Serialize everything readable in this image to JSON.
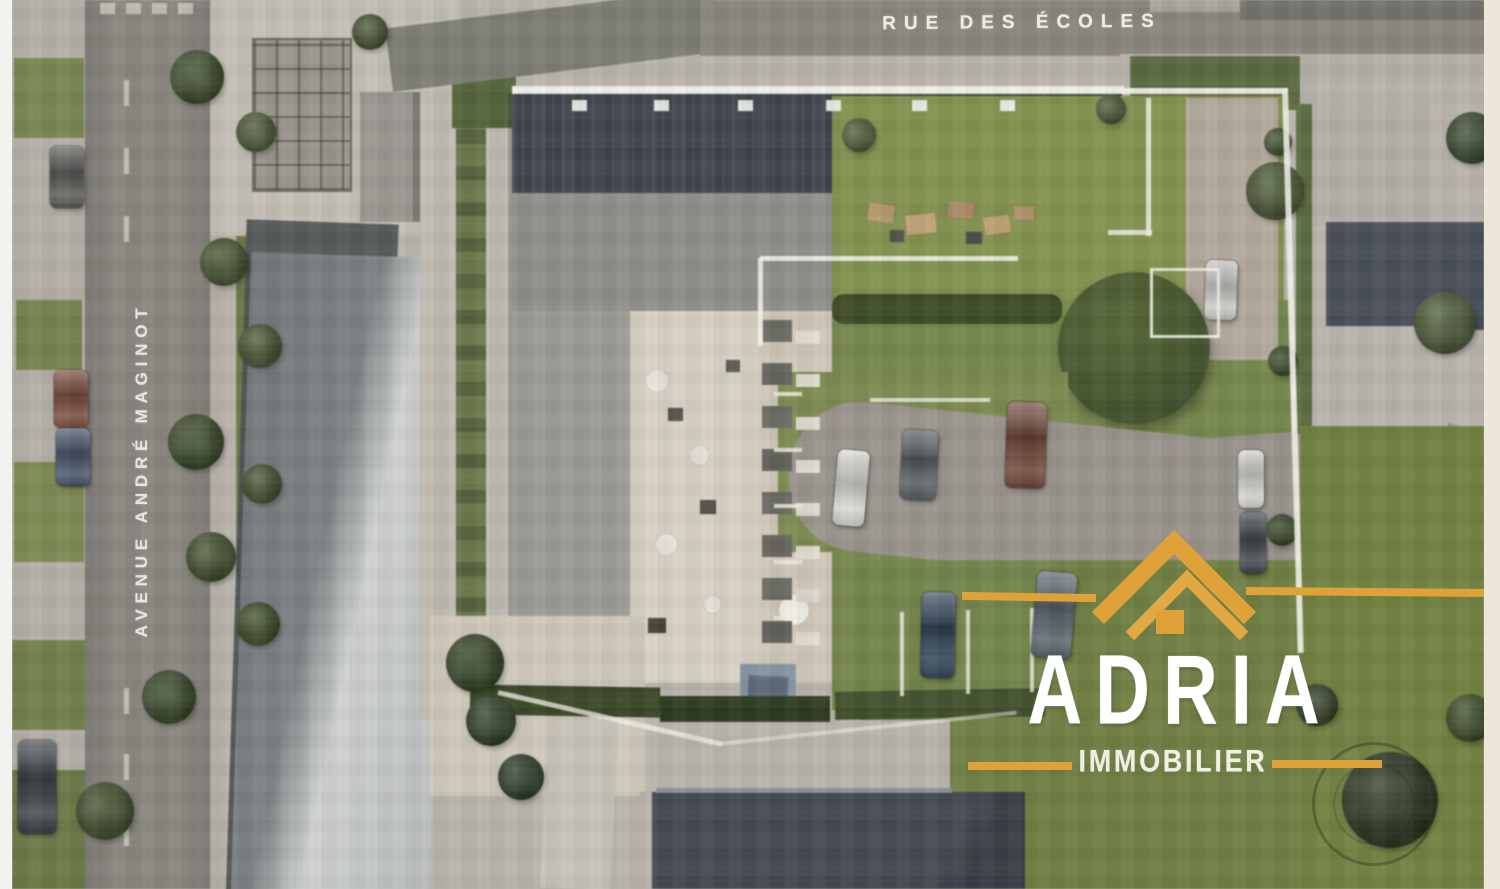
{
  "meta": {
    "kind": "aerial-site-render",
    "width": 1500,
    "height": 889
  },
  "streets": {
    "top": "RUE DES ÉCOLES",
    "left": "AVENUE ANDRÉ MAGINOT"
  },
  "logo": {
    "brand": "ADRIA",
    "tagline": "IMMOBILIER",
    "icon": "roof-icon",
    "gold": "#DFA239",
    "text_color": "#FFFFFF"
  },
  "palette": {
    "road": "#8A8680",
    "road_top": "#84817A",
    "pale_concrete": "#C4C0B7",
    "roof_dark_slate": "#3F444C",
    "roof_medium_gray": "#908F8B",
    "roof_light_wing": "#9C9B97",
    "warehouse_dark": "#757B7D",
    "warehouse_light": "#C8CBC9",
    "courtyard_beige": "#D8D2C4",
    "lawn_light": "#83934C",
    "lawn_mid": "#76874A",
    "lawn_dark": "#6F8040",
    "hedge": "#3E4C28",
    "drive": "#9A958D",
    "boundary_white": "#F2F1E8",
    "margin_left": "#F2F2EE",
    "margin_right": "#ECE7D8"
  },
  "scene": {
    "cars": [
      {
        "x": 50,
        "y": 146,
        "w": 34,
        "h": 62,
        "c": "#585A56"
      },
      {
        "x": 54,
        "y": 370,
        "w": 34,
        "h": 58,
        "c": "#7B4A3A"
      },
      {
        "x": 56,
        "y": 428,
        "w": 34,
        "h": 58,
        "c": "#44526A"
      },
      {
        "x": 18,
        "y": 740,
        "w": 38,
        "h": 94,
        "c": "#3A4046"
      },
      {
        "x": 835,
        "y": 450,
        "w": 32,
        "h": 76,
        "c": "#D8D8D2",
        "r": 5
      },
      {
        "x": 901,
        "y": 430,
        "w": 36,
        "h": 70,
        "c": "#555D60",
        "r": 3
      },
      {
        "x": 1006,
        "y": 402,
        "w": 40,
        "h": 86,
        "c": "#6E4434",
        "r": 2
      },
      {
        "x": 921,
        "y": 592,
        "w": 34,
        "h": 86,
        "c": "#2E4258",
        "r": 1
      },
      {
        "x": 1034,
        "y": 572,
        "w": 40,
        "h": 86,
        "c": "#57616B",
        "r": 5
      },
      {
        "x": 1238,
        "y": 450,
        "w": 26,
        "h": 58,
        "c": "#D5D5CF"
      },
      {
        "x": 1240,
        "y": 512,
        "w": 26,
        "h": 62,
        "c": "#3F464C"
      },
      {
        "x": 1205,
        "y": 260,
        "w": 32,
        "h": 60,
        "c": "#C9C9C4",
        "r": 2
      }
    ],
    "trees": [
      {
        "x": 170,
        "y": 50,
        "d": 54,
        "c": "#43532F"
      },
      {
        "x": 200,
        "y": 238,
        "d": 48,
        "c": "#4A5A33"
      },
      {
        "x": 168,
        "y": 414,
        "d": 56,
        "c": "#3F4F2C"
      },
      {
        "x": 186,
        "y": 532,
        "d": 50,
        "c": "#465630"
      },
      {
        "x": 142,
        "y": 670,
        "d": 54,
        "c": "#3E4E2B"
      },
      {
        "x": 76,
        "y": 782,
        "d": 58,
        "c": "#44542E"
      },
      {
        "x": 236,
        "y": 112,
        "d": 40,
        "c": "#51613B"
      },
      {
        "x": 238,
        "y": 324,
        "d": 44,
        "c": "#4B5B34"
      },
      {
        "x": 242,
        "y": 464,
        "d": 40,
        "c": "#475731"
      },
      {
        "x": 236,
        "y": 602,
        "d": 44,
        "c": "#43532A"
      },
      {
        "x": 352,
        "y": 14,
        "d": 36,
        "c": "#4A5A34"
      },
      {
        "x": 446,
        "y": 634,
        "d": 58,
        "c": "#3A4A29"
      },
      {
        "x": 466,
        "y": 696,
        "d": 50,
        "c": "#35452B"
      },
      {
        "x": 498,
        "y": 754,
        "d": 46,
        "c": "#32422B"
      },
      {
        "x": 842,
        "y": 118,
        "d": 34,
        "c": "#55653C"
      },
      {
        "x": 1096,
        "y": 94,
        "d": 30,
        "c": "#50603A"
      },
      {
        "x": 1246,
        "y": 162,
        "d": 58,
        "c": "#4D5D36"
      },
      {
        "x": 1264,
        "y": 128,
        "d": 28,
        "c": "#46562F"
      },
      {
        "x": 1268,
        "y": 346,
        "d": 30,
        "c": "#42522D"
      },
      {
        "x": 1266,
        "y": 514,
        "d": 32,
        "c": "#3E4E2A"
      },
      {
        "x": 1414,
        "y": 292,
        "d": 62,
        "c": "#51613B"
      },
      {
        "x": 1446,
        "y": 112,
        "d": 52,
        "c": "#3F4F31"
      },
      {
        "x": 1342,
        "y": 752,
        "d": 96,
        "c": "#2D3A20"
      },
      {
        "x": 1296,
        "y": 684,
        "d": 42,
        "c": "#37472A"
      },
      {
        "x": 1446,
        "y": 694,
        "d": 48,
        "c": "#415129"
      }
    ],
    "lane_dashes": [
      {
        "x": 124,
        "y": 80,
        "w": 5,
        "h": 26
      },
      {
        "x": 124,
        "y": 148,
        "w": 5,
        "h": 26
      },
      {
        "x": 124,
        "y": 216,
        "w": 5,
        "h": 26
      },
      {
        "x": 124,
        "y": 688,
        "w": 5,
        "h": 26
      },
      {
        "x": 124,
        "y": 754,
        "w": 5,
        "h": 26
      },
      {
        "x": 124,
        "y": 820,
        "w": 5,
        "h": 26
      },
      {
        "x": 100,
        "y": 3,
        "w": 15,
        "h": 11
      },
      {
        "x": 126,
        "y": 3,
        "w": 15,
        "h": 11
      },
      {
        "x": 152,
        "y": 3,
        "w": 15,
        "h": 11
      },
      {
        "x": 178,
        "y": 3,
        "w": 15,
        "h": 11
      }
    ],
    "stall_lines": [
      {
        "x": 774,
        "y": 392,
        "w": 28,
        "h": 4
      },
      {
        "x": 774,
        "y": 448,
        "w": 28,
        "h": 4
      },
      {
        "x": 774,
        "y": 504,
        "w": 28,
        "h": 4
      },
      {
        "x": 774,
        "y": 560,
        "w": 28,
        "h": 4
      },
      {
        "x": 774,
        "y": 616,
        "w": 28,
        "h": 4
      },
      {
        "x": 900,
        "y": 612,
        "w": 4,
        "h": 84
      },
      {
        "x": 966,
        "y": 610,
        "w": 4,
        "h": 84
      },
      {
        "x": 1030,
        "y": 608,
        "w": 4,
        "h": 84
      },
      {
        "x": 870,
        "y": 398,
        "w": 120,
        "h": 4
      }
    ],
    "skylights": [
      {
        "x": 572,
        "y": 100,
        "w": 15,
        "h": 11
      },
      {
        "x": 654,
        "y": 100,
        "w": 15,
        "h": 11
      },
      {
        "x": 738,
        "y": 100,
        "w": 15,
        "h": 11
      },
      {
        "x": 826,
        "y": 100,
        "w": 15,
        "h": 11
      },
      {
        "x": 912,
        "y": 100,
        "w": 15,
        "h": 11
      },
      {
        "x": 1000,
        "y": 100,
        "w": 15,
        "h": 11
      }
    ],
    "furniture": [
      {
        "x": 868,
        "y": 204,
        "w": 26,
        "h": 18,
        "c": "#B99A6E",
        "r": 8
      },
      {
        "x": 906,
        "y": 214,
        "w": 30,
        "h": 20,
        "c": "#C2A274",
        "r": -6
      },
      {
        "x": 948,
        "y": 202,
        "w": 26,
        "h": 16,
        "c": "#AE8E68",
        "r": 4
      },
      {
        "x": 984,
        "y": 216,
        "w": 26,
        "h": 18,
        "c": "#BFA070",
        "r": -8
      },
      {
        "x": 1014,
        "y": 206,
        "w": 20,
        "h": 14,
        "c": "#B4946C"
      },
      {
        "x": 890,
        "y": 230,
        "w": 14,
        "h": 12,
        "c": "#55534A"
      },
      {
        "x": 966,
        "y": 232,
        "w": 16,
        "h": 12,
        "c": "#50514A"
      },
      {
        "x": 646,
        "y": 370,
        "w": 22,
        "h": 22,
        "c": "#E8E6DE",
        "rd": 11
      },
      {
        "x": 690,
        "y": 446,
        "w": 19,
        "h": 19,
        "c": "#E3E1D9",
        "rd": 10
      },
      {
        "x": 656,
        "y": 534,
        "w": 21,
        "h": 21,
        "c": "#EAE8E0",
        "rd": 11
      },
      {
        "x": 704,
        "y": 596,
        "w": 17,
        "h": 17,
        "c": "#E5E3DB",
        "rd": 9
      },
      {
        "x": 779,
        "y": 595,
        "w": 30,
        "h": 30,
        "c": "#EFEEE6",
        "rd": 15
      },
      {
        "x": 668,
        "y": 408,
        "w": 15,
        "h": 13,
        "c": "#55534B"
      },
      {
        "x": 700,
        "y": 500,
        "w": 16,
        "h": 14,
        "c": "#4F4D45"
      },
      {
        "x": 648,
        "y": 618,
        "w": 18,
        "h": 15,
        "c": "#474539"
      },
      {
        "x": 726,
        "y": 360,
        "w": 14,
        "h": 12,
        "c": "#5A5850"
      }
    ],
    "balconies": [
      {
        "x": 762,
        "y": 320,
        "w": 30,
        "h": 22,
        "c": "#6B6B64"
      },
      {
        "x": 796,
        "y": 331,
        "w": 24,
        "h": 13,
        "c": "#E2DDD0"
      },
      {
        "x": 762,
        "y": 363,
        "w": 30,
        "h": 22,
        "c": "#66665F"
      },
      {
        "x": 796,
        "y": 374,
        "w": 24,
        "h": 13,
        "c": "#E2DDD0"
      },
      {
        "x": 762,
        "y": 406,
        "w": 30,
        "h": 22,
        "c": "#6B6B64"
      },
      {
        "x": 796,
        "y": 417,
        "w": 24,
        "h": 13,
        "c": "#DED9CC"
      },
      {
        "x": 762,
        "y": 449,
        "w": 30,
        "h": 22,
        "c": "#63635C"
      },
      {
        "x": 796,
        "y": 460,
        "w": 24,
        "h": 13,
        "c": "#E2DDD0"
      },
      {
        "x": 762,
        "y": 492,
        "w": 30,
        "h": 22,
        "c": "#6B6B64"
      },
      {
        "x": 796,
        "y": 503,
        "w": 24,
        "h": 13,
        "c": "#E0DBCE"
      },
      {
        "x": 762,
        "y": 535,
        "w": 30,
        "h": 22,
        "c": "#67675F"
      },
      {
        "x": 796,
        "y": 546,
        "w": 24,
        "h": 13,
        "c": "#E2DDD0"
      },
      {
        "x": 762,
        "y": 578,
        "w": 30,
        "h": 22,
        "c": "#6B6B64"
      },
      {
        "x": 796,
        "y": 589,
        "w": 24,
        "h": 13,
        "c": "#DDD8CB"
      },
      {
        "x": 762,
        "y": 621,
        "w": 30,
        "h": 22,
        "c": "#62625B"
      },
      {
        "x": 796,
        "y": 632,
        "w": 24,
        "h": 13,
        "c": "#E2DDD0"
      }
    ]
  }
}
